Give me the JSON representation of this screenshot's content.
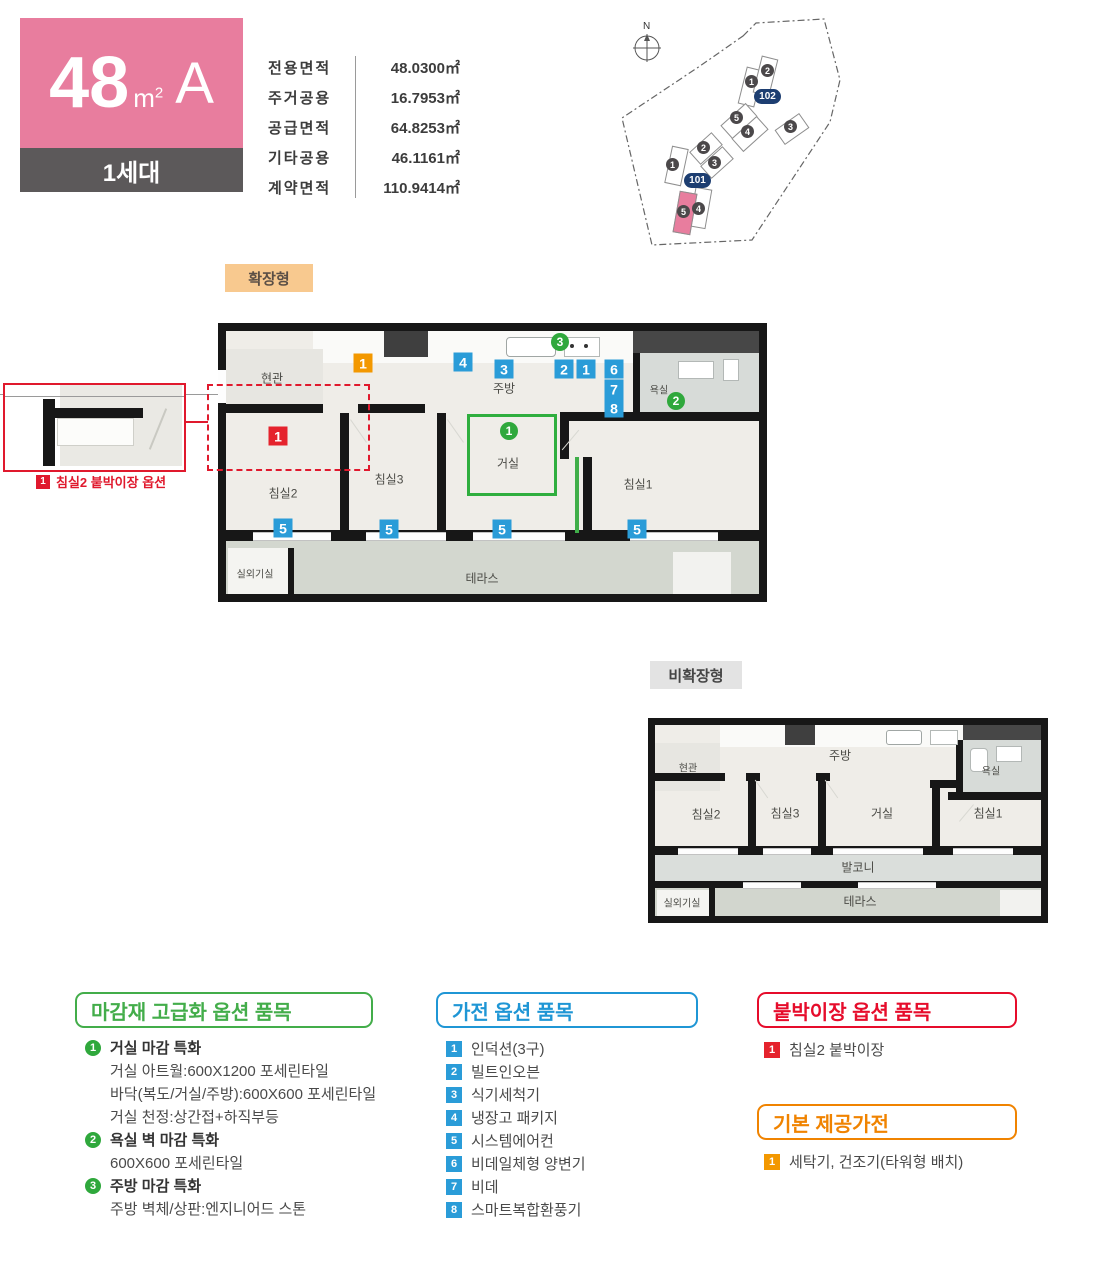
{
  "header": {
    "size": "48",
    "unit_base": "m",
    "unit_exp": "2",
    "type": "A",
    "generation": "1세대"
  },
  "area_table": {
    "rows": [
      {
        "label": "전용면적",
        "value": "48.0300㎡"
      },
      {
        "label": "주거공용",
        "value": "16.7953㎡"
      },
      {
        "label": "공급면적",
        "value": "64.8253㎡"
      },
      {
        "label": "기타공용",
        "value": "46.1161㎡"
      },
      {
        "label": "계약면적",
        "value": "110.9414㎡"
      }
    ]
  },
  "site_plan": {
    "north": "N",
    "labels": {
      "b101": "101",
      "b102": "102"
    },
    "units": {
      "u1": "1",
      "u2": "2",
      "u3": "3",
      "u4": "4",
      "u5": "5"
    }
  },
  "plan_extended": {
    "tag": "확장형",
    "rooms": {
      "entrance": "현관",
      "kitchen": "주방",
      "bath": "욕실",
      "living": "거실",
      "bed1": "침실1",
      "bed2": "침실2",
      "bed3": "침실3",
      "outdoor": "실외기실",
      "terrace": "테라스"
    },
    "badges": {
      "orange1": "1",
      "blue1": "1",
      "blue2": "2",
      "blue3": "3",
      "blue4": "4",
      "blue5": "5",
      "blue6": "6",
      "blue7": "7",
      "blue8": "8",
      "green1": "1",
      "green2": "2",
      "green3": "3",
      "red1": "1"
    }
  },
  "plan_basic": {
    "tag": "비확장형",
    "rooms": {
      "entrance": "현관",
      "kitchen": "주방",
      "bath": "욕실",
      "living": "거실",
      "bed1": "침실1",
      "bed2": "침실2",
      "bed3": "침실3",
      "balcony": "발코니",
      "outdoor": "실외기실",
      "terrace": "테라스"
    }
  },
  "inset": {
    "badge": "1",
    "caption": "침실2 붙박이장 옵션"
  },
  "legend_finish": {
    "title": "마감재 고급화 옵션 품목",
    "items": [
      {
        "num": "1",
        "name": "거실 마감 특화",
        "details": [
          "거실 아트월:600X1200 포세린타일",
          "바닥(복도/거실/주방):600X600 포세린타일",
          "거실 천정:상간접+하직부등"
        ]
      },
      {
        "num": "2",
        "name": "욕실 벽 마감 특화",
        "details": [
          "600X600 포세린타일"
        ]
      },
      {
        "num": "3",
        "name": "주방 마감 특화",
        "details": [
          "주방 벽체/상판:엔지니어드 스톤"
        ]
      }
    ]
  },
  "legend_appliance": {
    "title": "가전 옵션 품목",
    "items": [
      {
        "num": "1",
        "name": "인덕션(3구)"
      },
      {
        "num": "2",
        "name": "빌트인오븐"
      },
      {
        "num": "3",
        "name": "식기세척기"
      },
      {
        "num": "4",
        "name": "냉장고 패키지"
      },
      {
        "num": "5",
        "name": "시스템에어컨"
      },
      {
        "num": "6",
        "name": "비데일체형 양변기"
      },
      {
        "num": "7",
        "name": "비데"
      },
      {
        "num": "8",
        "name": "스마트복합환풍기"
      }
    ]
  },
  "legend_closet": {
    "title": "붙박이장 옵션 품목",
    "items": [
      {
        "num": "1",
        "name": "침실2 붙박이장"
      }
    ]
  },
  "legend_basic": {
    "title": "기본 제공가전",
    "items": [
      {
        "num": "1",
        "name": "세탁기, 건조기(타워형 배치)"
      }
    ]
  },
  "colors": {
    "pink": "#e87d9e",
    "dark": "#5c595a",
    "blue": "#2a9cd8",
    "green": "#2fa83c",
    "red": "#e5232d",
    "orange": "#f39800",
    "legend_green": "#43ad4a",
    "legend_blue": "#1f96d5",
    "legend_red": "#e60c2b",
    "legend_orange": "#f08300",
    "navy": "#1d3e71"
  }
}
